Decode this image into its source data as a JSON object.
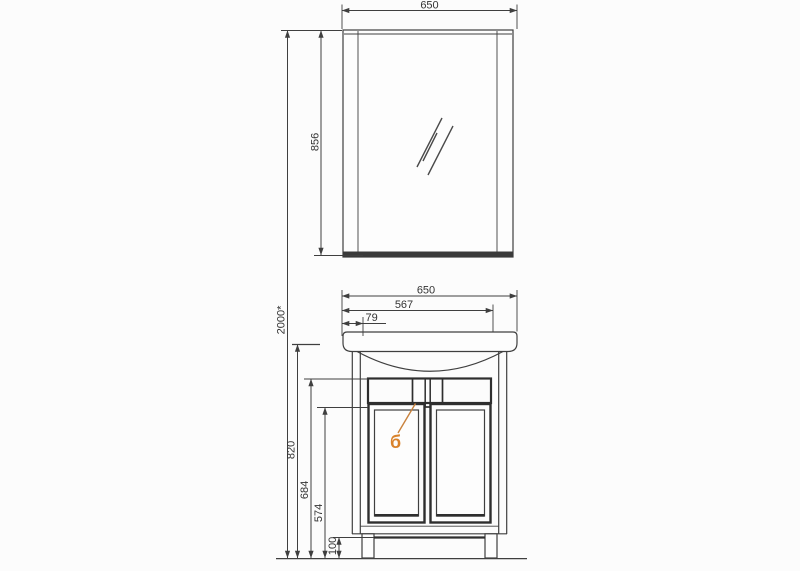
{
  "drawing": {
    "title": "vanity-unit-with-mirror-dimension-drawing",
    "labels": {
      "mirror_width_top": "650",
      "mirror_height": "856",
      "overall_height": "2000*",
      "basin_width": "650",
      "basin_to_door_right_width": "567",
      "basin_edge_offset": "79",
      "cabinet_height": "820",
      "apron_top_height": "684",
      "apron_bottom_height": "574",
      "plinth_height": "100",
      "callout": "б"
    },
    "colors": {
      "line": "#3f3f3f",
      "dark_edge": "#2e2e2e",
      "apron_fill": "#d8d8dc",
      "mirror_bottom_bar": "#3a3a3a",
      "callout_accent": "#d9822b",
      "background": "#fcfcfc"
    }
  }
}
